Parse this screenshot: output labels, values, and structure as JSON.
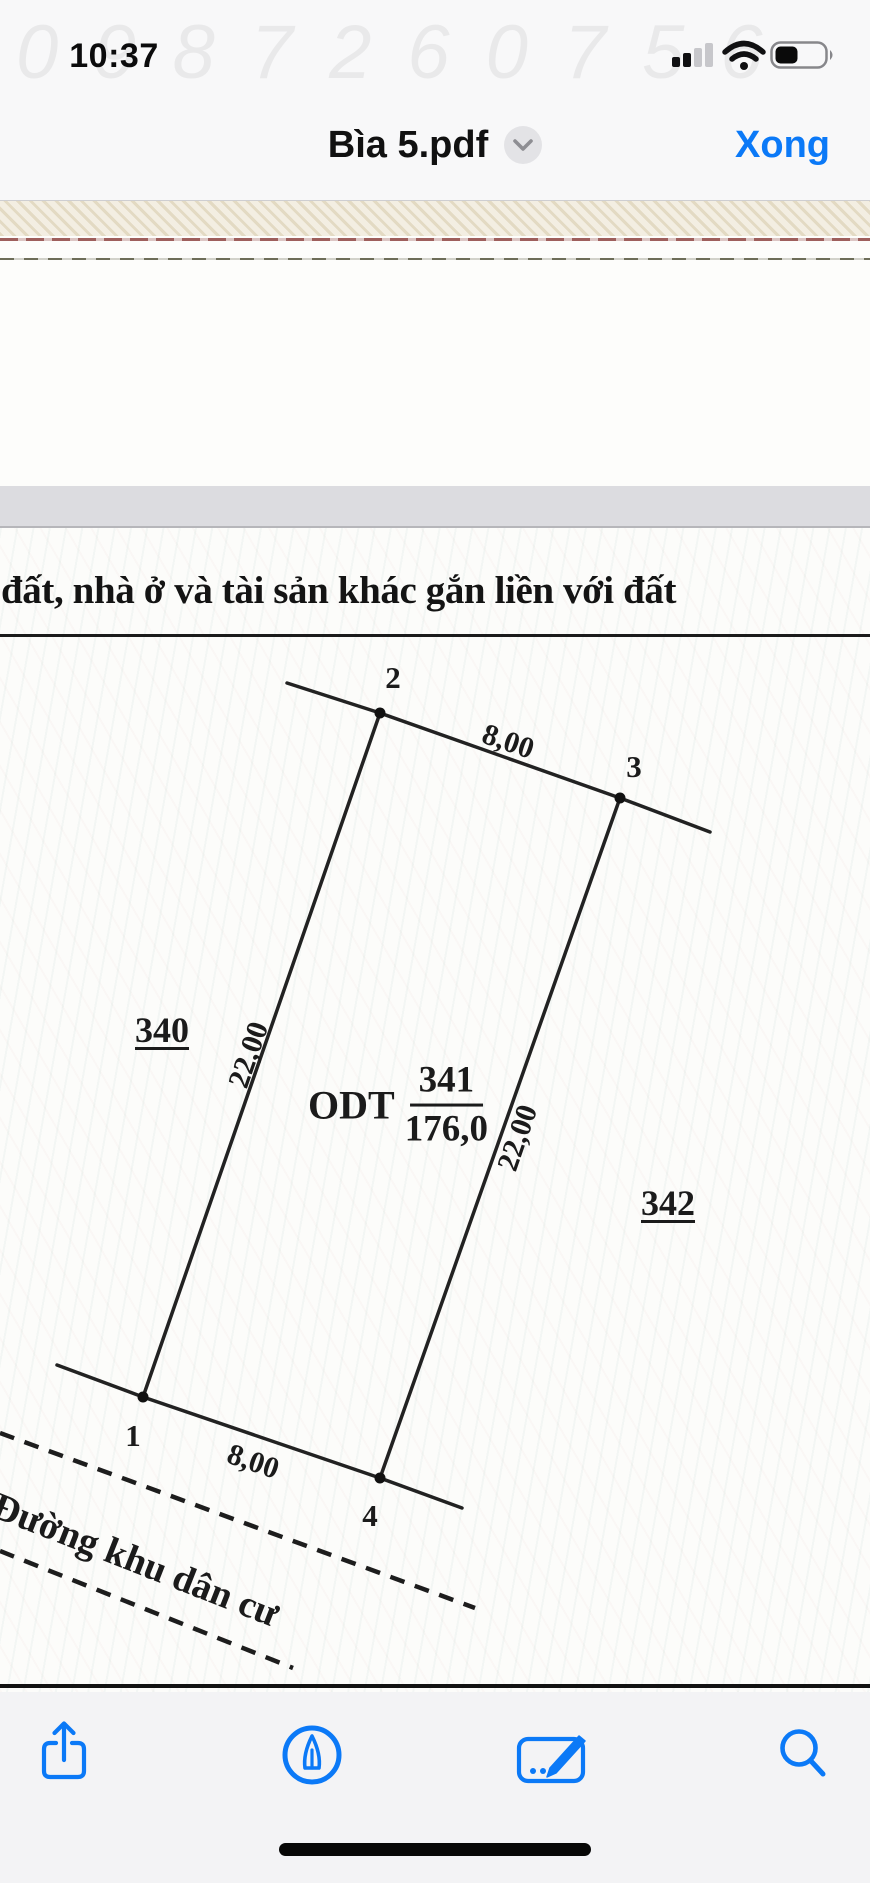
{
  "status_bar": {
    "time": "10:37",
    "icons": {
      "cellular": "cellular-signal-icon",
      "wifi": "wifi-icon",
      "battery": "battery-icon"
    }
  },
  "watermark": {
    "text": "0987260756"
  },
  "nav_bar": {
    "title": "Bìa 5.pdf",
    "done_label": "Xong"
  },
  "document": {
    "heading": "đất, nhà ở và tài sản khác gắn liền với đất",
    "diagram": {
      "plot_code": "ODT",
      "plot_number": "341",
      "plot_area": "176,0",
      "neighbor_left": "340",
      "neighbor_right": "342",
      "points": {
        "p1": "1",
        "p2": "2",
        "p3": "3",
        "p4": "4"
      },
      "edge_top": "8,00",
      "edge_bottom": "8,00",
      "edge_left": "22,00",
      "edge_right": "22,00",
      "road": "Đường khu dân cư"
    }
  },
  "toolbar": {
    "buttons": [
      {
        "icon": "share"
      },
      {
        "icon": "markup"
      },
      {
        "icon": "signature"
      },
      {
        "icon": "search"
      }
    ]
  },
  "colors": {
    "accent": "#0b79f7",
    "page_gap": "#dcdce0"
  }
}
